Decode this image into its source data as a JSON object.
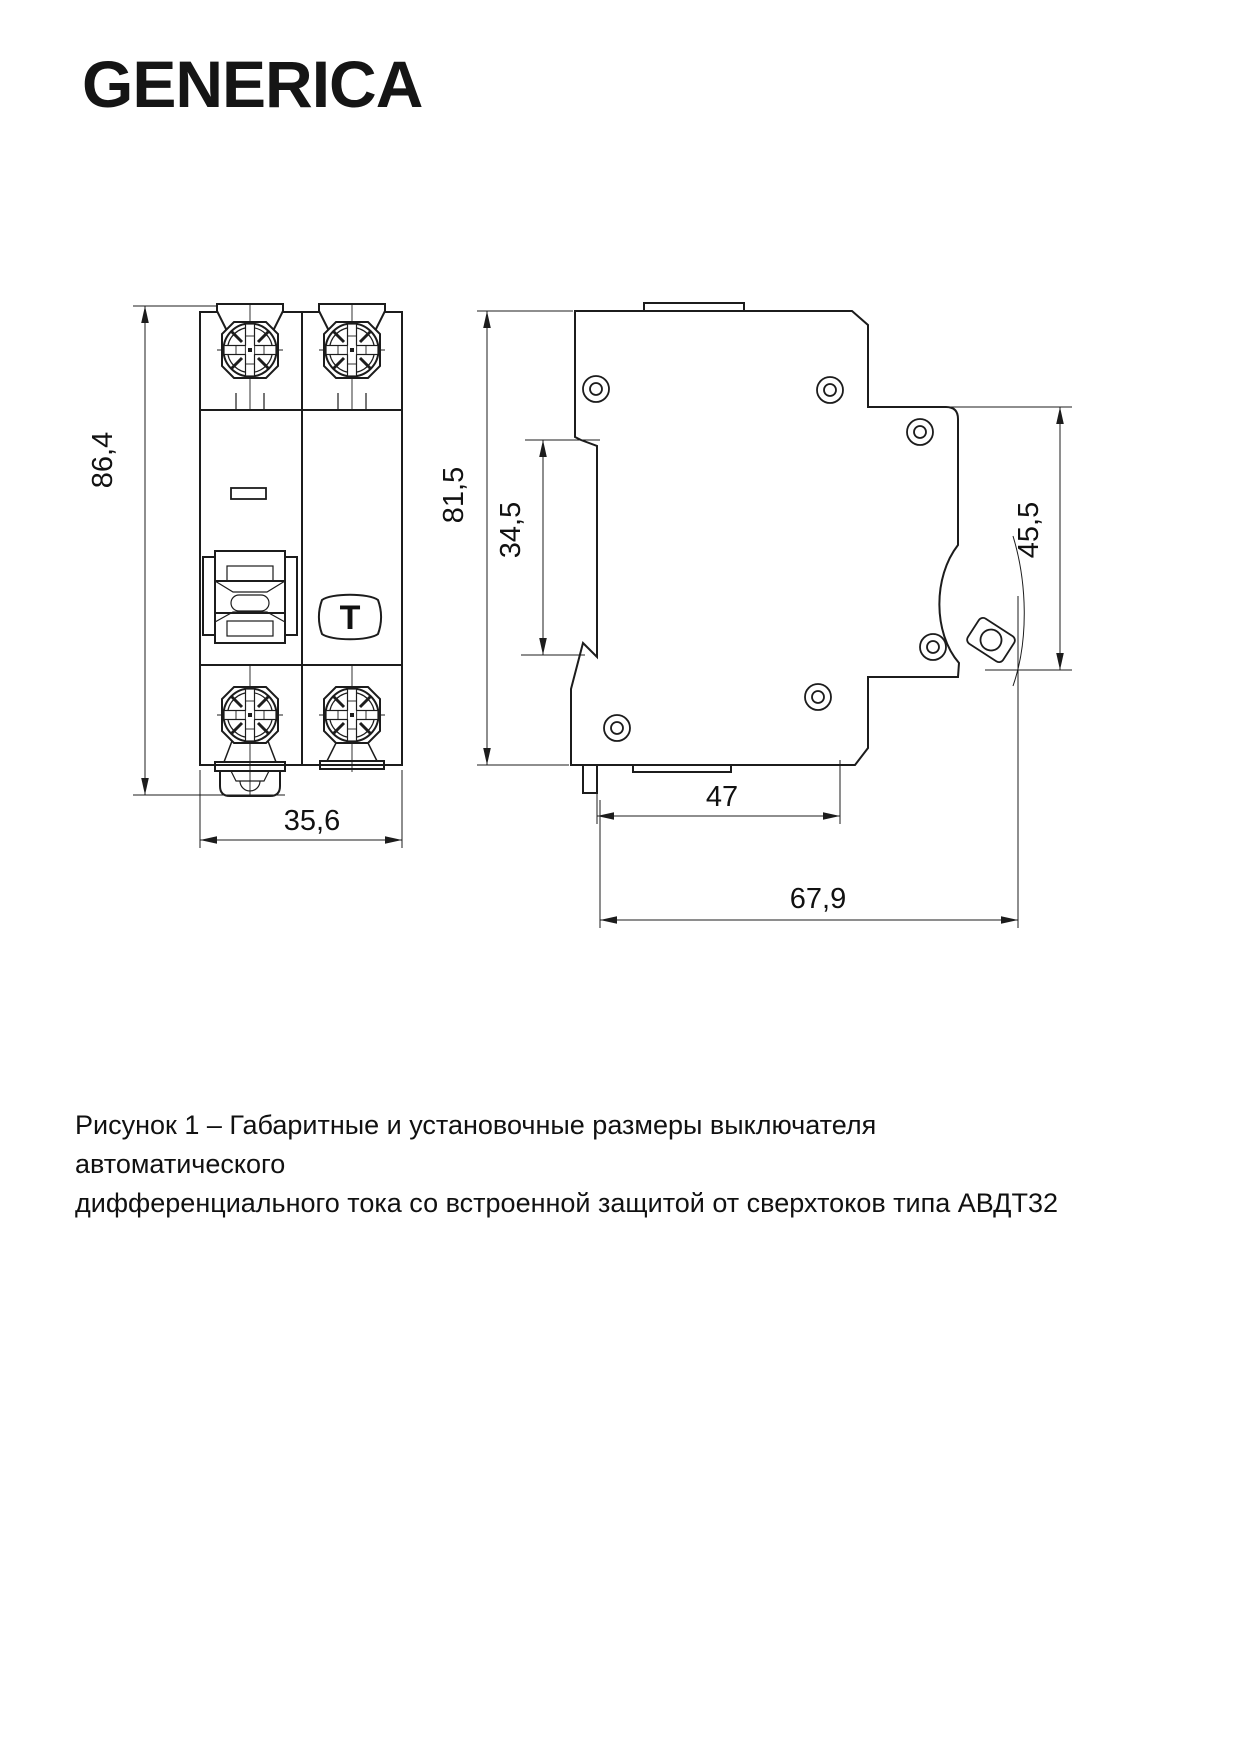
{
  "brand": {
    "logo_text": "GENERICA"
  },
  "drawing": {
    "front_view": {
      "dim_height": "86,4",
      "dim_width": "35,6",
      "test_button_label": "T"
    },
    "side_view": {
      "dim_height": "81,5",
      "dim_din_offset": "34,5",
      "dim_mount_height": "45,5",
      "dim_depth_body": "47",
      "dim_depth_total": "67,9"
    },
    "ink_color": "#1c1c1c"
  },
  "caption": {
    "line1": "Рисунок 1 – Габаритные и установочные размеры выключателя автоматического",
    "line2": "дифференциального тока со встроенной защитой от сверхтоков типа АВДТ32"
  }
}
